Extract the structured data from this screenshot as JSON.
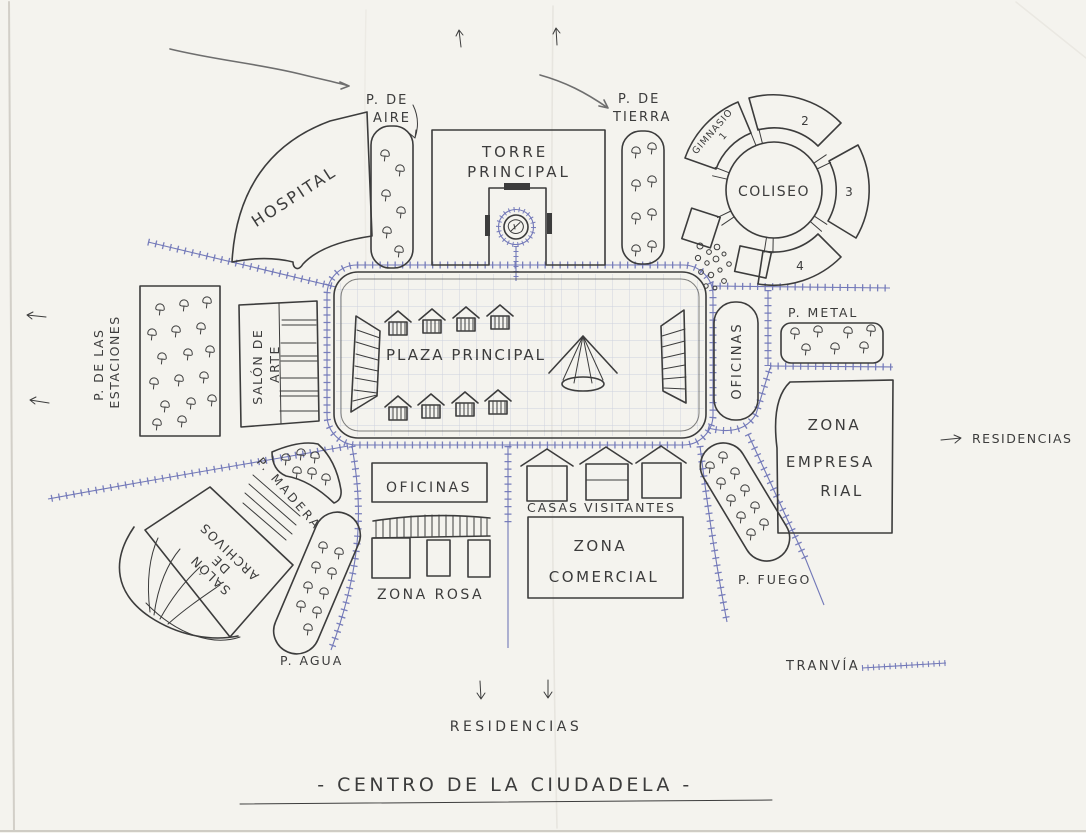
{
  "document": {
    "title": "- CENTRO  DE  LA  CIUDADELA -"
  },
  "colors": {
    "ink": "#3c3c3c",
    "road": "#7278b8",
    "grid": "#ccd0dd",
    "paper": "#f4f3ee"
  },
  "places": {
    "p_de_aire": {
      "line1": "P. DE",
      "line2": "AIRE"
    },
    "torre_principal": {
      "line1": "TORRE",
      "line2": "PRINCIPAL"
    },
    "p_de_tierra": {
      "line1": "P. DE",
      "line2": "TIERRA"
    },
    "gimnasio": {
      "line1": "GIMNASIO",
      "line2": "1"
    },
    "coliseo": {
      "name": "COLISEO",
      "seg2": "2",
      "seg3": "3",
      "seg4": "4"
    },
    "hospital": {
      "name": "HOSPITAL"
    },
    "p_estaciones": {
      "line1": "P. DE LAS",
      "line2": "ESTACIONES"
    },
    "salon_arte": {
      "line1": "SALÓN DE",
      "line2": "ARTE"
    },
    "plaza_principal": {
      "name": "PLAZA  PRINCIPAL"
    },
    "oficinas_este": {
      "name": "OFICINAS"
    },
    "p_metal": {
      "name": "P.  METAL"
    },
    "zona_empresarial": {
      "line1": "ZONA",
      "line2": "EMPRESA",
      "line3": "RIAL"
    },
    "residencias_este": {
      "name": "RESIDENCIAS"
    },
    "p_madera": {
      "name": "P. MADERA"
    },
    "salon_archivos": {
      "line1": "SALÓN",
      "line2": "DE",
      "line3": "ARCHIVOS"
    },
    "p_agua": {
      "name": "P. AGUA"
    },
    "oficinas_sur": {
      "name": "OFICINAS"
    },
    "zona_rosa": {
      "name": "ZONA  ROSA"
    },
    "casas_visitantes": {
      "line1": "CASAS",
      "line2": "VISITANTES"
    },
    "zona_comercial": {
      "line1": "ZONA",
      "line2": "COMERCIAL"
    },
    "p_fuego": {
      "name": "P.  FUEGO"
    },
    "tranvia": {
      "name": "TRANVÍA"
    },
    "residencias_sur": {
      "name": "RESIDENCIAS"
    }
  }
}
